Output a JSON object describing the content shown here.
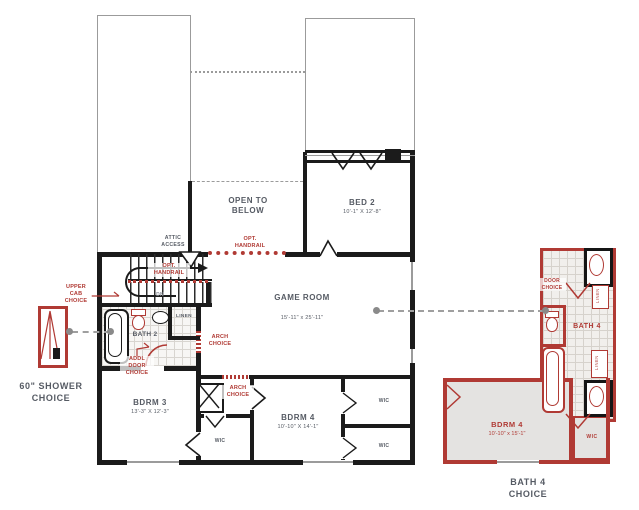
{
  "colors": {
    "wall": "#1b1b1b",
    "thin_outline": "#9b9b9b",
    "option_red": "#b03a34",
    "label_gray": "#565b64",
    "room_fill_gray": "#e4e3e1"
  },
  "labels": {
    "open_to_below": "OPEN TO BELOW",
    "bed2": "BED 2",
    "bed2_dims": "10'-1\" X 12'-8\"",
    "game_room": "GAME ROOM",
    "game_room_dims": "15'-11\" x 25'-11\"",
    "bath2": "BATH 2",
    "linen": "LINEN",
    "dn": "DN",
    "attic_access": "ATTIC ACCESS",
    "bdrm3": "BDRM 3",
    "bdrm3_dims": "13'-3\" X 12'-3\"",
    "bdrm4": "BDRM 4",
    "bdrm4_dims": "10'-10\" X 14'-1\"",
    "wic": "WIC"
  },
  "options": {
    "upper_cab": "UPPER CAB CHOICE",
    "opt_handrail_stairs": "OPT. HANDRAIL",
    "opt_handrail_open": "OPT. HANDRAIL",
    "addl_door": "ADDL DOOR CHOICE",
    "arch_choice_1": "ARCH CHOICE",
    "arch_choice_2": "ARCH CHOICE",
    "door_choice": "DOOR CHOICE",
    "bath4": "BATH 4",
    "bdrm4_opt": "BDRM 4",
    "bdrm4_opt_dims": "10'-10\" x 15'-1\"",
    "wic": "WIC",
    "linen": "LINEN"
  },
  "captions": {
    "shower": "60\" SHOWER CHOICE",
    "bath4_choice": "BATH 4 CHOICE"
  }
}
